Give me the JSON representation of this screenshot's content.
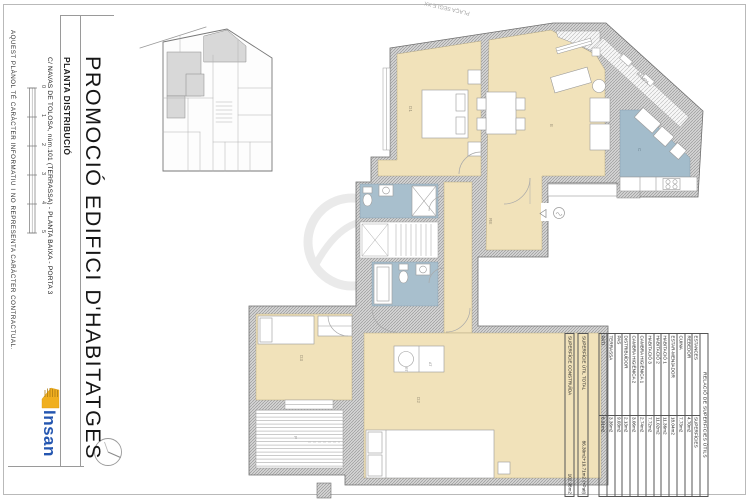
{
  "sheet": {
    "title": "PROMOCIÓ EDIFICI D'HABITATGES",
    "subtitle": "PLANTA DISTRIBUCIÓ",
    "address": "C/ NAVAS DE TOLOSA, núm.101 (TERRASSA) - PLANTA BAIXA - PORTA 3",
    "disclaimer": "AQUEST PLÀNOL TÉ CARÀCTER INFORMATIU I NO REPRESENTA CARÀCTER CONTRACTUAL.",
    "logo_text": "Insan",
    "scale_ticks": [
      "0",
      "1",
      "2",
      "3",
      "4",
      "5"
    ]
  },
  "plan": {
    "street_label": "PLAÇA SEGLE XX",
    "ramp_label": "RAMPA",
    "room_labels": {
      "h1": "D1",
      "living": "E",
      "kitchen": "C",
      "h2": "D2",
      "h3": "D3",
      "terrace": "P",
      "hall": "RE"
    },
    "laundry": {
      "left": "RT",
      "right": "AT"
    }
  },
  "areas_table": {
    "title": "RELACIÓ DE SUPERFÍCIES ÚTILS",
    "col_rooms": "ESTANCES",
    "col_areas": "SUPERFÍCIES",
    "rows": [
      {
        "label": "REBEDOR",
        "value": "4.70m2"
      },
      {
        "label": "CUINA",
        "value": "7.73m2"
      },
      {
        "label": "ESTAR-MENJADOR",
        "value": "18.04m2"
      },
      {
        "label": "HABITACIÓ 1",
        "value": "11.36m2"
      },
      {
        "label": "HABITACIÓ 2",
        "value": "11.02m2"
      },
      {
        "label": "HABITACIÓ 3",
        "value": "7.72m2"
      },
      {
        "label": "CAMBRA HIGIÈNICA 1",
        "value": "2.74m2"
      },
      {
        "label": "CAMBRA HIGIÈNICA 2",
        "value": "3.06m2"
      },
      {
        "label": "DISTRIBUÏDOR",
        "value": "2.13m2"
      },
      {
        "label": "PAS",
        "value": "9.03m2"
      },
      {
        "label": "TERRASSA",
        "value": "3.36m2"
      },
      {
        "label": "PATI",
        "value": "8.91m2"
      }
    ],
    "totals": [
      {
        "label": "SUPERFÍCIE ÚTIL TOTAL",
        "value": "86.30m2+19.71m2 (+Pati)"
      },
      {
        "label": "SUPERFÍCIE CONSTRUÏDA",
        "value": "102.98m2"
      }
    ]
  },
  "colors": {
    "floor_beige": "#f1e2ba",
    "wet_blue": "#a3bccb",
    "wall_gray": "#d4d4d4",
    "logo_blue": "#2456b0",
    "logo_yellow": "#f0af1f"
  }
}
